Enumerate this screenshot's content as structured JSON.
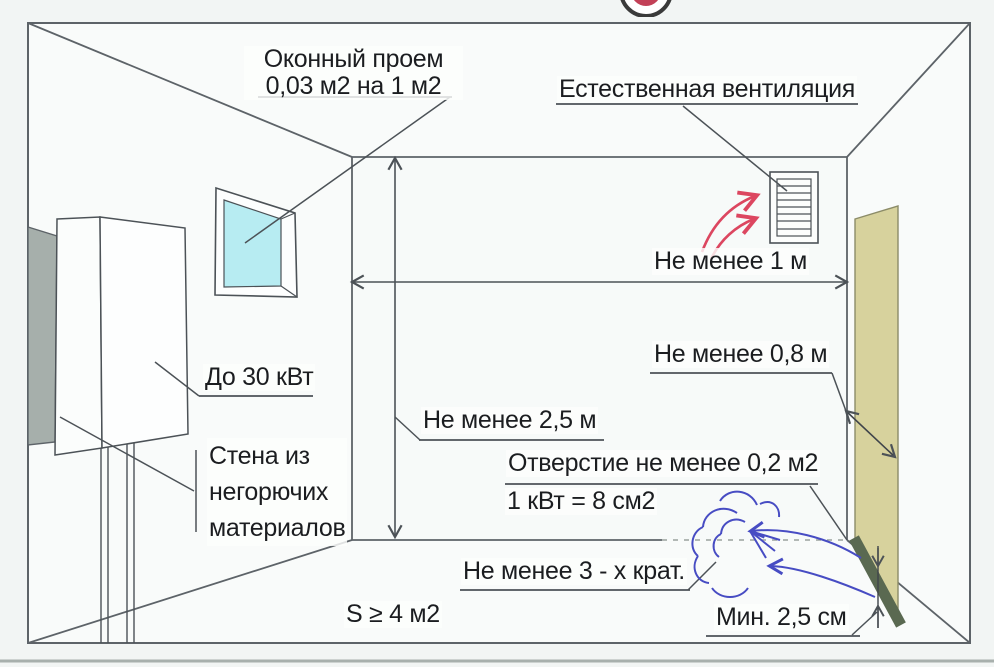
{
  "diagram_title": "Требования к помещению газового котла — вентиляция и размеры",
  "labels": {
    "window_opening": {
      "line1": "Оконный проем",
      "line2": "0,03 м2 на 1 м2"
    },
    "natural_ventilation": "Естественная вентиляция",
    "min_distance_1m": "Не менее 1 м",
    "min_distance_08m": "Не менее 0,8 м",
    "boiler_power": "До 30 кВт",
    "wall_material": {
      "line1": "Стена из",
      "line2": "негорючих",
      "line3": "материалов"
    },
    "min_height_25m": "Не менее 2,5 м",
    "opening_area": "Отверстие не менее 0,2 м2",
    "kw_ratio": "1 кВт = 8 см2",
    "air_exchange": "Не менее 3 - х крат.",
    "room_area": "S ≥ 4 м2",
    "door_gap": "Мин. 2,5 см"
  },
  "colors": {
    "line": "#4c5257",
    "window_glass": "#b7ecf2",
    "door_panel": "#d7d29d",
    "door_gap_strip": "#5a6951",
    "wall_panel_gray": "#a6afab",
    "supply_air_arrow_red": "#dc4660",
    "intake_air_arrow_blue": "#474cc3",
    "logo_red": "#c24057"
  }
}
